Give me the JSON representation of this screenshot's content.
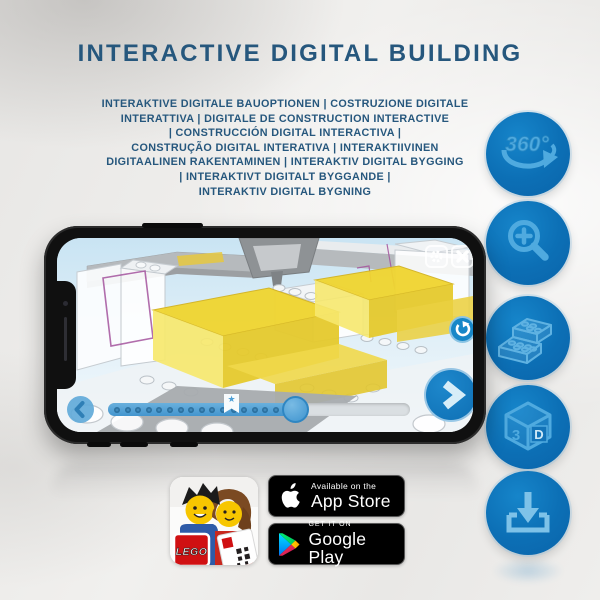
{
  "header": {
    "title": "INTERACTIVE DIGITAL BUILDING",
    "subtitle": "INTERAKTIVE DIGITALE BAUOPTIONEN | COSTRUZIONE DIGITALE\nINTERATTIVA | DIGITALE DE CONSTRUCTION INTERACTIVE\n| CONSTRUCCIÓN DIGITAL INTERACTIVA |\nCONSTRUÇÃO DIGITAL INTERATIVA | INTERAKTIIVINEN\nDIGITAALINEN RAKENTAMINEN | INTERAKTIV DIGITAL BYGGING\n| INTERAKTIVT DIGITALT BYGGANDE |\nINTERAKTIV DIGITAL BYGNING"
  },
  "feature_icons": [
    {
      "id": "rotate-360",
      "label": "360°"
    },
    {
      "id": "zoom-in"
    },
    {
      "id": "brick-options"
    },
    {
      "id": "view-3d",
      "digit": "3",
      "letter": "D"
    },
    {
      "id": "download"
    }
  ],
  "phone_app": {
    "slider_progress_percent": 62
  },
  "badges": {
    "lego_logo_text": "LEGO",
    "app_store": {
      "line1": "Available on the",
      "line2": "App Store"
    },
    "google_play": {
      "line1": "GET IT ON",
      "line2": "Google Play"
    }
  },
  "colors": {
    "title_blue": "#26577D",
    "circle_blue": "#0C6FB5",
    "icon_light_blue": "#4FAADF",
    "brick_yellow": "#EFD431",
    "app_accent_blue": "#1787C8"
  }
}
